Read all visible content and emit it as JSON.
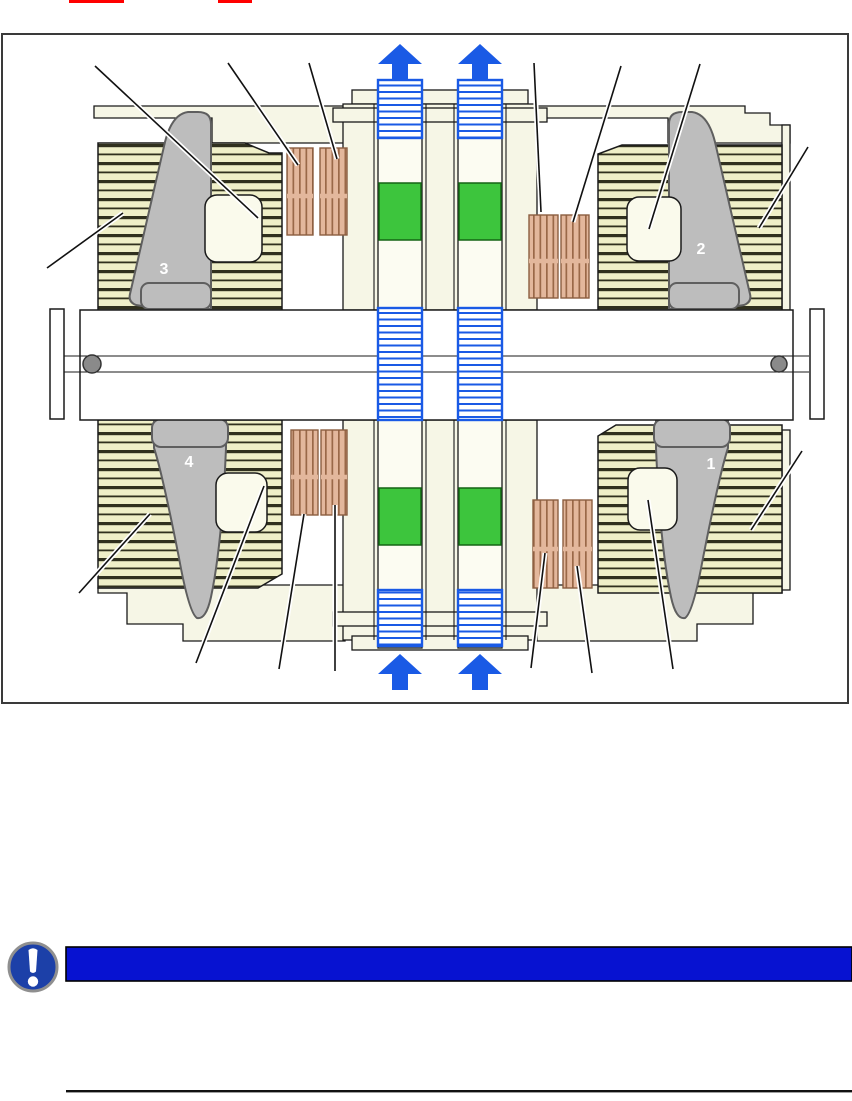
{
  "figure": {
    "kind": "machine-cross-section-diagram",
    "labels": {
      "sector_1": "1",
      "sector_2": "2",
      "sector_3": "3",
      "sector_4": "4"
    },
    "colors": {
      "housing_cream": "#F6F6E6",
      "winding_yellow": "#EFEFC8",
      "wedge_gray": "#BDBDBD",
      "coil_orange": "#E3B79C",
      "duct_green": "#3DC53D",
      "cooling_blue": "#1A5AE5",
      "red_mark": "#FF0000"
    }
  },
  "notice": {
    "icon": "exclamation-circle-icon",
    "bar_text": "",
    "bar_color": "#0712D1",
    "icon_color": "#1C40A8"
  }
}
